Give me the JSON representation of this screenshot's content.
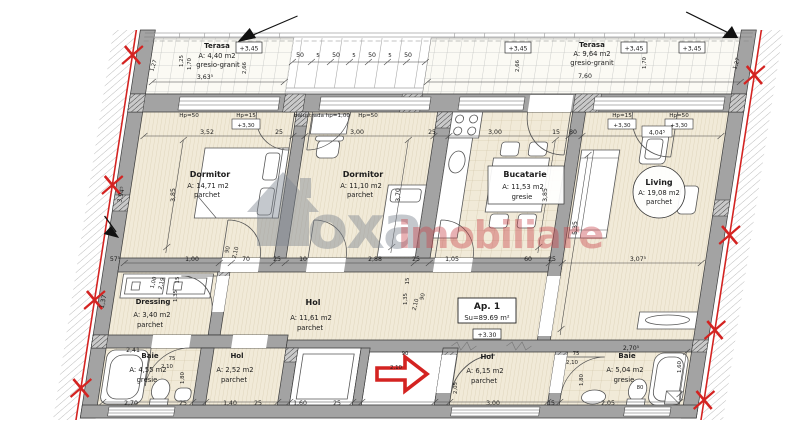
{
  "watermark": {
    "gray": "oxa",
    "red": "imobiliare"
  },
  "apartment": {
    "label": "Ap. 1",
    "area": "Su=89.69 m²",
    "level": "+3.30"
  },
  "levels": {
    "terrace": "+3,45",
    "floor": "+3,30"
  },
  "sill_labels": {
    "hp50": "Hp=50",
    "hp15": "Hp=15",
    "balustrade": "balustrada hp=1,00"
  },
  "rooms": {
    "terasa_left": {
      "name": "Terasa",
      "area": "A: 4,40 m2",
      "floor": "gresio-granit"
    },
    "terasa_right": {
      "name": "Terasa",
      "area": "A: 9,64 m2",
      "floor": "gresio-granit"
    },
    "dormitor1": {
      "name": "Dormitor",
      "area": "A: 14,71 m2",
      "floor": "parchet"
    },
    "dormitor2": {
      "name": "Dormitor",
      "area": "A: 11,10 m2",
      "floor": "parchet"
    },
    "bucatarie": {
      "name": "Bucatarie",
      "area": "A: 11,53 m2",
      "floor": "gresie"
    },
    "living": {
      "name": "Living",
      "area": "A: 19,08 m2",
      "floor": "parchet"
    },
    "dressing": {
      "name": "Dressing",
      "area": "A: 3,40 m2",
      "floor": "parchet"
    },
    "hol": {
      "name": "Hol",
      "area": "A: 11,61 m2",
      "floor": "parchet"
    },
    "baie1": {
      "name": "Baie",
      "area": "A: 4,55 m2",
      "floor": "gresie"
    },
    "hol2": {
      "name": "Hol",
      "area": "A: 2,52 m2",
      "floor": "parchet"
    },
    "hol3": {
      "name": "Hol",
      "area": "A: 6,15 m2",
      "floor": "parchet"
    },
    "baie2": {
      "name": "Baie",
      "area": "A: 5,04 m2",
      "floor": "gresie"
    }
  },
  "dims": {
    "top": [
      "3,52",
      "25",
      "3,00",
      "25",
      "3,00",
      "15",
      "80",
      "4,04⁵"
    ],
    "mid": [
      "57⁵",
      "1,00",
      "70",
      "25",
      "10",
      "2,88",
      "25",
      "1,05",
      "60",
      "25",
      "3,07⁵"
    ],
    "bottom": [
      "2,70",
      "25",
      "1,40",
      "25",
      "1,60",
      "25",
      "3,00",
      "15",
      "2,05"
    ],
    "rail": [
      "50",
      "5",
      "50",
      "5",
      "50",
      "5",
      "50"
    ],
    "vertical": [
      "3,85",
      "3,70",
      "3,85",
      "5,35",
      "3,94⁵",
      "1,37",
      "15",
      "1,35",
      "1,80",
      "1,80",
      "2,05",
      "1,60",
      "15",
      "1,35"
    ],
    "terrace_left": [
      "3,63⁵",
      "1,27",
      "1,25",
      "1,70",
      "2,66"
    ],
    "terrace_right": [
      "7,60",
      "2,66",
      "1,70",
      "1,27"
    ],
    "doors": [
      "90",
      "2,10",
      "90",
      "2,10",
      "75",
      "2,10",
      "75",
      "2,10",
      "90",
      "2,10",
      "1,00",
      "2,19"
    ],
    "misc": [
      "2,41",
      "2,70⁵",
      "80"
    ]
  },
  "colors": {
    "accent_red": "#d42321",
    "wall_gray": "#a3a3a3",
    "floor_beige": "#f1ead8"
  }
}
